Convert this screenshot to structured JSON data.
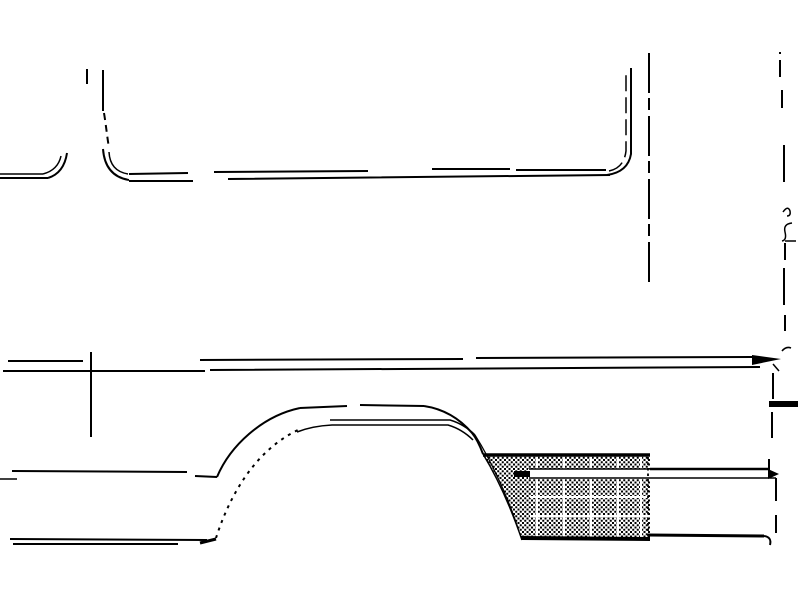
{
  "drawing": {
    "title": "van-side-panel-wheel-arch-line-art",
    "canvas": {
      "width": 800,
      "height": 600
    },
    "background_color": "#ffffff",
    "stroke_color": "#000000",
    "hatch_color": "#000000",
    "elements": [
      {
        "name": "window-divider-tick",
        "d": "M87,69 L87,84",
        "w": 2
      },
      {
        "name": "window-divider-line",
        "d": "M103,70 L103,111",
        "w": 2
      },
      {
        "name": "window-divider-dashes",
        "d": "M104,113 C106,125 107,136 109,148",
        "w": 2,
        "dash": "7 5"
      },
      {
        "name": "mid-window-corner-outer",
        "d": "M103,149 Q105,176 129,180",
        "w": 2
      },
      {
        "name": "mid-window-corner-inner",
        "d": "M109,152 Q110,171 128,174",
        "w": 1.5
      },
      {
        "name": "left-window-corner-outer",
        "d": "M48,178 Q64,173 67,153",
        "w": 2
      },
      {
        "name": "left-window-corner-inner",
        "d": "M43,174 Q58,170 61,156",
        "w": 1.5
      },
      {
        "name": "beltline-left-upper",
        "d": "M0,174 L43,174",
        "w": 1.5
      },
      {
        "name": "beltline-left-lower",
        "d": "M0,178 L48,178",
        "w": 2
      },
      {
        "name": "beltline-upper",
        "d": "M129,174 L188,173 M214,172 L368,171 M432,169 L510,169 M516,170 L606,170",
        "w": 2
      },
      {
        "name": "beltline-lower",
        "d": "M129,181 L193,181 M228,179 L610,175",
        "w": 2
      },
      {
        "name": "rear-window-corner-outer",
        "d": "M607,175 Q628,172 631,154 L631,68",
        "w": 2
      },
      {
        "name": "rear-window-corner-inner",
        "d": "M609,171 Q624,168 626,151 L626,72",
        "w": 1.5,
        "dash": "16 6"
      },
      {
        "name": "rear-body-edge",
        "d": "M649,53 L649,287",
        "w": 2,
        "dash": "40 5 12 6"
      },
      {
        "name": "rear-cut-line-top",
        "d": "M780,52 L780,54 M780,60 L780,77 M782,90 L782,108 M784,145 L784,182",
        "w": 2
      },
      {
        "name": "rear-hinge-upper",
        "d": "M783,212 Q788,205 790,211 Q791,216 787,216",
        "w": 1.5
      },
      {
        "name": "rear-hinge-lower",
        "d": "M792,223 Q783,224 785,232 Q787,240 782,241",
        "w": 1.5
      },
      {
        "name": "rear-cut-tick",
        "d": "M785,241 L796,241",
        "w": 1.5
      },
      {
        "name": "rear-cut-line-mid",
        "d": "M785,243 L785,260 M784,268 L784,305 M785,315 L785,331",
        "w": 2
      },
      {
        "name": "rear-corner-squiggle",
        "d": "M782,351 Q786,346 791,348",
        "w": 1.5
      },
      {
        "name": "molding-upper",
        "d": "M8,361 L83,361 M200,360 L463,359 M476,358 L752,357",
        "w": 2
      },
      {
        "name": "molding-lower",
        "d": "M3,371 L205,371 M210,370 L760,367",
        "w": 2
      },
      {
        "name": "molding-seam-tick",
        "d": "M91,352 L91,437",
        "w": 2
      },
      {
        "name": "molding-end-arrow",
        "d": "M752,355 L781,359 L752,365 Z",
        "fill": "#000000"
      },
      {
        "name": "molding-end-tick",
        "d": "M773,364 L779,371",
        "w": 1.5
      },
      {
        "name": "rear-edge-upper",
        "d": "M773,373 L773,399",
        "w": 2
      },
      {
        "name": "rear-edge-bar",
        "d": "M769,404 L798,404",
        "w": 6
      },
      {
        "name": "rear-edge-lower",
        "d": "M772,412 L772,438",
        "w": 2
      },
      {
        "name": "sill-top-line",
        "d": "M12,471 L187,472 M195,476 L217,477",
        "w": 2
      },
      {
        "name": "sill-top-left-stub",
        "d": "M0,479 L17,479",
        "w": 1.5
      },
      {
        "name": "sill-bottom-upper",
        "d": "M10,539 L207,540",
        "w": 2
      },
      {
        "name": "sill-bottom-lower",
        "d": "M13,544 L178,544",
        "w": 2
      },
      {
        "name": "sill-arch-junction",
        "d": "M200,543 L216,539",
        "w": 3
      },
      {
        "name": "arch-outer-left",
        "d": "M217,477 C230,446 262,416 300,408",
        "w": 2
      },
      {
        "name": "arch-outer-top-dashed",
        "d": "M300,408 L347,406 M360,405 L424,406",
        "w": 2
      },
      {
        "name": "arch-outer-right",
        "d": "M424,406 C444,409 460,419 472,433 C477,439 480,446 483,454",
        "w": 2
      },
      {
        "name": "arch-flange-upper",
        "d": "M330,420 L450,420 C460,423 468,428 475,435",
        "w": 1.5
      },
      {
        "name": "arch-flange-lower",
        "d": "M297,432 Q312,426 332,425 L448,425 C458,428 466,433 473,440",
        "w": 1.5
      },
      {
        "name": "arch-inner-dotted",
        "d": "M216,538 C230,494 256,450 298,430",
        "w": 2,
        "dash": "3 5"
      },
      {
        "name": "hatch-inner-curve",
        "d": "M475,435 C492,462 508,498 518,528",
        "w": 1.2
      },
      {
        "name": "hatch-left-edge",
        "d": "M483,454 C497,477 511,508 522,540",
        "w": 1.5
      },
      {
        "name": "hatch-area",
        "d": "M483,454 L650,454 L650,540 L522,540 C512,506 498,476 483,454 Z",
        "fill": "hatch"
      },
      {
        "name": "hatch-white-columns",
        "d": "M537,456 L537,538 M564,456 L564,538 M591,456 L591,538 M618,456 L618,538 M641,456 L641,538",
        "w": 2,
        "color": "#ffffff"
      },
      {
        "name": "hatch-white-rows",
        "d": "M530,497 L648,497 M530,516 L648,516",
        "w": 2,
        "color": "#ffffff"
      },
      {
        "name": "panel-molding-stripe",
        "d": "M528,469 L650,469 L650,479 L528,479 Z",
        "fill": "#ffffff"
      },
      {
        "name": "panel-molding-stripe-top",
        "d": "M529,469 L650,469",
        "w": 1.5
      },
      {
        "name": "panel-molding-stripe-bottom",
        "d": "M529,478 L650,478",
        "w": 1.5
      },
      {
        "name": "panel-molding-end-cap",
        "d": "M514,471 L530,471 L530,477 L514,477 Z",
        "fill": "#000000"
      },
      {
        "name": "panel-top-edge",
        "d": "M483,455 L650,455",
        "w": 3.5
      },
      {
        "name": "panel-bottom-edge",
        "d": "M521,538 L650,539",
        "w": 4
      },
      {
        "name": "panel-right-edge",
        "d": "M648,457 L648,537",
        "w": 1.8,
        "dash": "2.5 3"
      },
      {
        "name": "quarter-molding-upper",
        "d": "M650,469 L768,469",
        "w": 2.5
      },
      {
        "name": "quarter-molding-tick",
        "d": "M769,459 L769,470",
        "w": 2
      },
      {
        "name": "quarter-molding-arrow",
        "d": "M768,469 L779,474 L768,479 Z",
        "fill": "#000000"
      },
      {
        "name": "quarter-molding-lower",
        "d": "M650,478 L776,478",
        "w": 1.5
      },
      {
        "name": "quarter-sill-bottom",
        "d": "M648,535 L764,536",
        "w": 3
      },
      {
        "name": "quarter-sill-hook",
        "d": "M764,536 Q772,537 770,545",
        "w": 2
      },
      {
        "name": "rear-edge-dash-a",
        "d": "M776,478 L776,501",
        "w": 2
      },
      {
        "name": "rear-edge-dash-b",
        "d": "M776,515 L776,533",
        "w": 2
      }
    ]
  }
}
